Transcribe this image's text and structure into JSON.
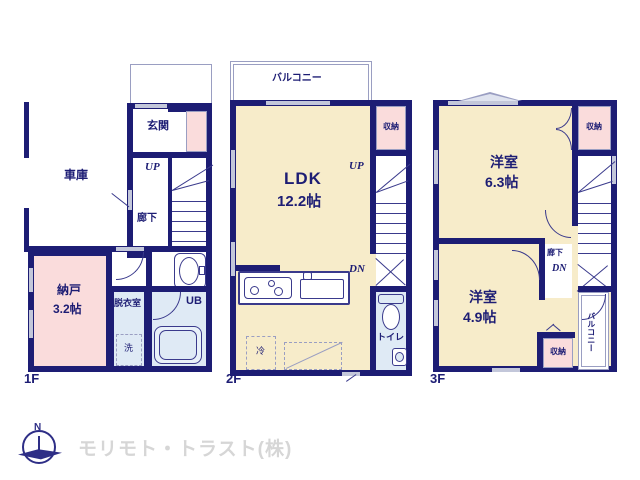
{
  "colors": {
    "wall": "#1d1d74",
    "room_cream": "#f7ecca",
    "closet_pink": "#fadcdc",
    "wet_blue": "#dfeaf5",
    "line": "#3a3a8c",
    "window_gray": "#c3c7da",
    "logo_gray": "#d6d6d6"
  },
  "floor1": {
    "label": "1F",
    "garage": "車庫",
    "entrance": "玄関",
    "up": "UP",
    "hallway": "廊下",
    "storage": "納戸",
    "storage_size": "3.2帖",
    "dressing": "脱衣室",
    "washer": "洗",
    "bath": "UB"
  },
  "floor2": {
    "label": "2F",
    "balcony": "バルコニー",
    "closet": "収納",
    "up": "UP",
    "dn": "DN",
    "ldk": "LDK",
    "ldk_size": "12.2帖",
    "fridge": "冷",
    "toilet": "トイレ"
  },
  "floor3": {
    "label": "3F",
    "room_a": "洋室",
    "room_a_size": "6.3帖",
    "closet_top": "収納",
    "hallway": "廊下",
    "dn": "DN",
    "room_b": "洋室",
    "room_b_size": "4.9帖",
    "closet_bottom": "収納",
    "balcony": "バルコニー"
  },
  "footer": {
    "company": "モリモト・トラスト(株)",
    "compass": "N"
  }
}
